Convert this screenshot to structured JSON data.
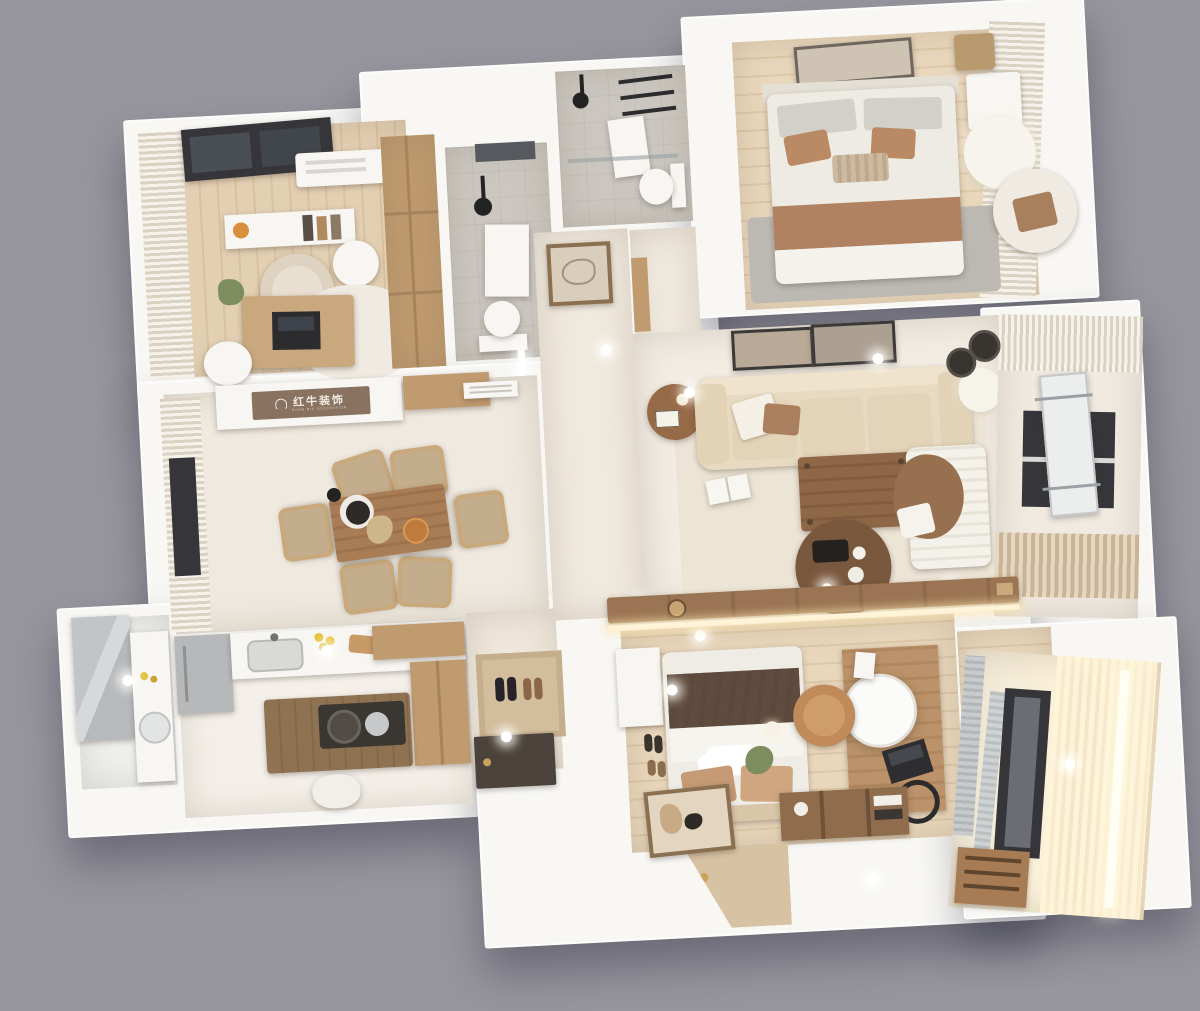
{
  "scene": {
    "type": "3d-floorplan-render",
    "description": "Top-down dollhouse render of a furnished beige/white apartment on a plain gray backdrop"
  },
  "watermark": {
    "brand_cn": "红牛装饰",
    "brand_en": "HONG NIU DECORATION",
    "icon": "bull-logo-icon"
  },
  "colors": {
    "bg": "#97969e",
    "wall": "#f8f7f4",
    "wood-floor": "#e3cfb2",
    "wood-floor2": "#e9d7bc",
    "tile": "#efe9df",
    "tile-gray": "#cbc7c0",
    "wood-mid": "#c09b6f",
    "wood-dark": "#8f6a49",
    "sofa": "#e8dac1",
    "rug-living": "#ece4d5",
    "rug-gray": "#bcb8b2",
    "pillow-tan": "#c59a74",
    "blanket-brown": "#5f4c3e",
    "throw-brown": "#b08262",
    "accent-orange": "#c57947",
    "glow": "#fff3d8",
    "sign": "#8a7261",
    "sign-text": "#f2ebe2",
    "plant-green": "#7d8d5f",
    "dark-frame": "#36363a"
  },
  "rooms": [
    {
      "id": "study",
      "label": "Study",
      "furniture": [
        "curtains",
        "window",
        "ac-unit",
        "window-desk",
        "armchair",
        "side-table",
        "desk",
        "laptop",
        "rug",
        "stool",
        "plant"
      ]
    },
    {
      "id": "wardrobe-hall",
      "label": "Closet hall",
      "furniture": [
        "wardrobe"
      ]
    },
    {
      "id": "bathroom-shower",
      "label": "Shower bathroom",
      "furniture": [
        "shower",
        "mirror",
        "towel",
        "toilet"
      ]
    },
    {
      "id": "bathroom-top",
      "label": "Guest bathroom",
      "furniture": [
        "shower",
        "towel-ladder",
        "towel",
        "toilet",
        "glass-partition"
      ]
    },
    {
      "id": "hallway",
      "label": "Hallway",
      "furniture": [
        "wall-art",
        "light-bar",
        "door"
      ]
    },
    {
      "id": "bedroom-2",
      "label": "Second bedroom",
      "furniture": [
        "double-bed",
        "pillows",
        "brown-throw",
        "gray-rug",
        "nightstand",
        "pendant-light",
        "armchair",
        "curtains",
        "wall-picture"
      ]
    },
    {
      "id": "living-room",
      "label": "Living room",
      "furniture": [
        "sofa",
        "pillows",
        "wall-frames",
        "side-table",
        "coffee-table",
        "round-table",
        "rug",
        "open-book",
        "chaise",
        "floor-lamp"
      ]
    },
    {
      "id": "side-balcony",
      "label": "Side balcony",
      "furniture": [
        "curtains",
        "window",
        "drying-rack",
        "pans"
      ]
    },
    {
      "id": "dining-room",
      "label": "Dining room",
      "furniture": [
        "dining-table",
        "six-chairs",
        "teapot-tray",
        "flowers",
        "pizza-plate",
        "curtains",
        "window",
        "brand-sign-cabinet",
        "vent"
      ]
    },
    {
      "id": "kitchen",
      "label": "Kitchen",
      "furniture": [
        "fridge",
        "counter",
        "sink",
        "cutting-board",
        "lemons",
        "island",
        "cooktop",
        "pans",
        "stool",
        "tall-cabinet"
      ]
    },
    {
      "id": "laundry-bath",
      "label": "Utility bathroom",
      "furniture": [
        "mirror",
        "counter",
        "sink"
      ]
    },
    {
      "id": "entry",
      "label": "Entry",
      "furniture": [
        "doormat",
        "shoes",
        "front-door"
      ]
    },
    {
      "id": "master-bedroom",
      "label": "Master bedroom",
      "furniture": [
        "double-bed",
        "cloud-pillow",
        "dark-blanket",
        "slippers",
        "vanity-desk",
        "round-mirror",
        "laptop",
        "ring-light",
        "desk-chair",
        "bookshelf",
        "plant",
        "leaning-frame",
        "tv-console"
      ]
    },
    {
      "id": "wardrobe-corner",
      "label": "Wardrobe corner",
      "furniture": [
        "armchair",
        "orange-pillow"
      ]
    },
    {
      "id": "master-balcony",
      "label": "Master balcony",
      "furniture": [
        "glowing-curtain",
        "window",
        "bookshelf",
        "mirror-panels"
      ]
    }
  ]
}
